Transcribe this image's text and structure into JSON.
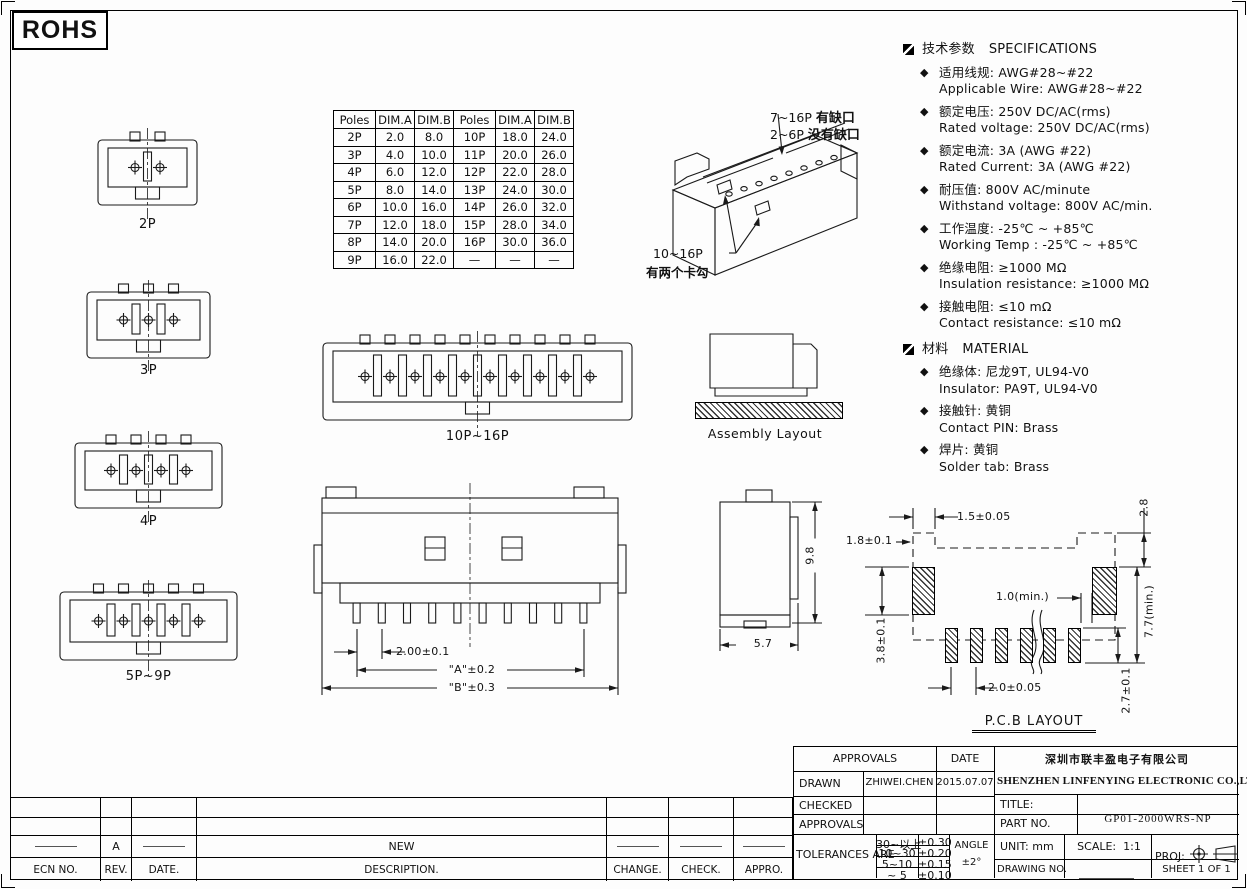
{
  "page": {
    "rohs": "ROHS"
  },
  "poles_table": {
    "headers": [
      "Poles",
      "DIM.A",
      "DIM.B",
      "Poles",
      "DIM.A",
      "DIM.B"
    ],
    "rows": [
      [
        "2P",
        "2.0",
        "8.0",
        "10P",
        "18.0",
        "24.0"
      ],
      [
        "3P",
        "4.0",
        "10.0",
        "11P",
        "20.0",
        "26.0"
      ],
      [
        "4P",
        "6.0",
        "12.0",
        "12P",
        "22.0",
        "28.0"
      ],
      [
        "5P",
        "8.0",
        "14.0",
        "13P",
        "24.0",
        "30.0"
      ],
      [
        "6P",
        "10.0",
        "16.0",
        "14P",
        "26.0",
        "32.0"
      ],
      [
        "7P",
        "12.0",
        "18.0",
        "15P",
        "28.0",
        "34.0"
      ],
      [
        "8P",
        "14.0",
        "20.0",
        "16P",
        "30.0",
        "36.0"
      ],
      [
        "9P",
        "16.0",
        "22.0",
        "—",
        "—",
        "—"
      ]
    ]
  },
  "views": {
    "front_2p": "2P",
    "front_3p": "3P",
    "front_4p": "4P",
    "front_5p9p": "5P~9P",
    "front_10p16p": "10P~16P",
    "assembly": "Assembly Layout",
    "pcb": "P.C.B LAYOUT"
  },
  "callouts": {
    "notch_line1_pre": "7~16P",
    "notch_line1_bold": "有缺口",
    "notch_line2_pre": "2~6P",
    "notch_line2_bold": "没有缺口",
    "hook_line1": "10~16P",
    "hook_line2": "有两个卡勾"
  },
  "dims": {
    "back": {
      "pitch": "2.00±0.1",
      "a": "\"A\"±0.2",
      "b": "\"B\"±0.3"
    },
    "side": {
      "height": "9.8",
      "depth": "5.7"
    },
    "pcb": {
      "top_offset": "1.5±0.05",
      "left_offset": "1.8±0.1",
      "right_top": "2.8",
      "pad_height": "3.8±0.1",
      "min_gap": "1.0(min.)",
      "span_min": "7.7(min.)",
      "pitch": "2.0±0.05",
      "small_pad_height": "2.7±0.1"
    }
  },
  "specs": {
    "bullet_item": "◆",
    "sections": [
      {
        "title_cn": "技术参数",
        "title_en": "SPECIFICATIONS",
        "items": [
          {
            "cn": "适用线规:  AWG#28~#22",
            "en": "Applicable Wire:  AWG#28~#22"
          },
          {
            "cn": "额定电压:  250V DC/AC(rms)",
            "en": "Rated voltage:  250V DC/AC(rms)"
          },
          {
            "cn": "额定电流:  3A (AWG #22)",
            "en": "Rated Current:  3A (AWG #22)"
          },
          {
            "cn": "耐压值:  800V AC/minute",
            "en": "Withstand voltage:  800V AC/min."
          },
          {
            "cn": "工作温度:  -25℃ ~ +85℃",
            "en": "Working Temp : -25℃ ~ +85℃"
          },
          {
            "cn": "绝缘电阻:  ≥1000 MΩ",
            "en": "Insulation resistance:  ≥1000 MΩ"
          },
          {
            "cn": "接触电阻:  ≤10 mΩ",
            "en": "Contact resistance:  ≤10 mΩ"
          }
        ]
      },
      {
        "title_cn": "材料",
        "title_en": "MATERIAL",
        "items": [
          {
            "cn": "绝缘体:  尼龙9T, UL94-V0",
            "en": "Insulator:  PA9T, UL94-V0"
          },
          {
            "cn": "接触针:  黄铜",
            "en": "Contact PIN:  Brass"
          },
          {
            "cn": "焊片:  黄铜",
            "en": "Solder tab:  Brass"
          }
        ]
      }
    ]
  },
  "title_block": {
    "approvals_header": "APPROVALS",
    "date_header": "DATE",
    "drawn_label": "DRAWN",
    "drawn_name": "ZHIWEI.CHEN",
    "drawn_date": "2015.07.07",
    "checked_label": "CHECKED",
    "approvals_label": "APPROVALS",
    "tolerances_label": "TOLERANCES ARE",
    "tolerances": [
      {
        "range": "30~以上",
        "value": "±0.30"
      },
      {
        "range": "10~30",
        "value": "±0.20"
      },
      {
        "range": "5~10",
        "value": "±0.15"
      },
      {
        "range": "~ 5",
        "value": "±0.10"
      }
    ],
    "angle_label": "ANGLE",
    "angle_value": "±2°",
    "company_cn": "深圳市联丰盈电子有限公司",
    "company_en": "SHENZHEN LINFENYING ELECTRONIC CO.,LTD",
    "title_label": "TITLE:",
    "title_value": "",
    "part_no_label": "PART NO.",
    "part_no_value": "GP01-2000WRS-NP",
    "unit_label": "UNIT:",
    "unit_value": "mm",
    "scale_label": "SCALE:",
    "scale_value": "1:1",
    "proj_label": "PROJ:",
    "drawing_no_label": "DRAWING NO.",
    "sheet_label": "SHEET  1 OF 1"
  },
  "revision_table": {
    "headers": [
      "ECN NO.",
      "REV.",
      "DATE.",
      "DESCRIPTION.",
      "CHANGE.",
      "CHECK.",
      "APPRO."
    ],
    "rows": [
      [
        "",
        "",
        "",
        "",
        "",
        "",
        ""
      ],
      [
        "",
        "",
        "",
        "",
        "",
        "",
        ""
      ],
      [
        "—",
        "A",
        "—",
        "NEW",
        "—",
        "—",
        "—"
      ]
    ]
  }
}
